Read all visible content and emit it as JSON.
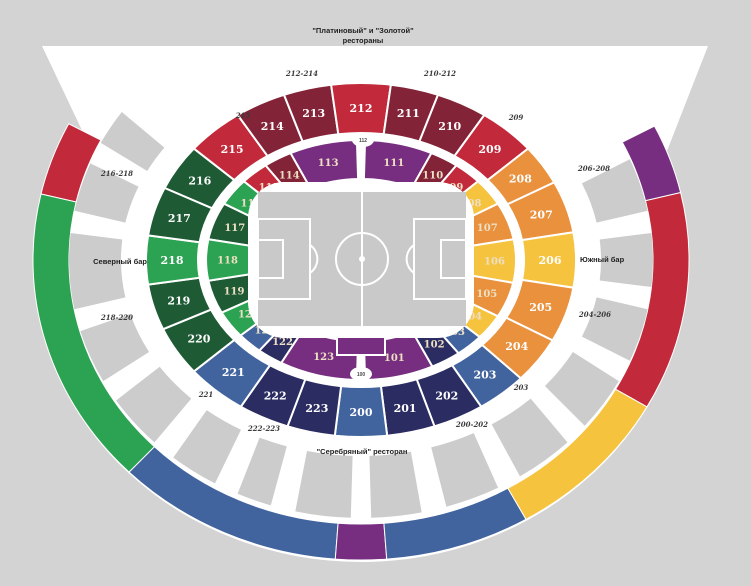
{
  "canvas": {
    "width": 751,
    "height": 586,
    "bg": "#d3d3d3"
  },
  "palette": {
    "red": "#c2293a",
    "maroon": "#832337",
    "purple": "#772d80",
    "green": "#2ca352",
    "dgreen": "#1e5b35",
    "blue": "#41649f",
    "navy": "#2b2c61",
    "orange": "#e9913d",
    "yellow": "#f5c33e",
    "suite": "#cccccc",
    "pitch": "#c9c9c9",
    "white": "#ffffff"
  },
  "labels": {
    "top_restaurant_line1": "\"Платиновый\" и \"Золотой\"",
    "top_restaurant_line2": "рестораны",
    "north_bar": "Северный бар",
    "south_bar": "Южный бар",
    "silver_restaurant": "\"Серебряный\" ресторан"
  },
  "area_labels": [
    {
      "id": "restaurants-line1",
      "t": "\"Платиновый\" и \"Золотой\"",
      "x": 363,
      "y": 33,
      "anchor": "middle"
    },
    {
      "id": "restaurants-line2",
      "t": "рестораны",
      "x": 363,
      "y": 43,
      "anchor": "middle"
    },
    {
      "id": "north-bar",
      "t": "Северный бар",
      "x": 147,
      "y": 264,
      "anchor": "end"
    },
    {
      "id": "south-bar",
      "t": "Южный бар",
      "x": 580,
      "y": 262,
      "anchor": "start"
    },
    {
      "id": "silver-restaurant",
      "t": "\"Серебряный\" ресторан",
      "x": 362,
      "y": 454,
      "anchor": "middle"
    }
  ],
  "gate_labels": [
    {
      "t": "212-214",
      "x": 302,
      "y": 76
    },
    {
      "t": "210-212",
      "x": 440,
      "y": 76
    },
    {
      "t": "215",
      "x": 243,
      "y": 118
    },
    {
      "t": "209",
      "x": 516,
      "y": 120
    },
    {
      "t": "216-218",
      "x": 117,
      "y": 176
    },
    {
      "t": "218-220",
      "x": 117,
      "y": 320
    },
    {
      "t": "206-208",
      "x": 594,
      "y": 171
    },
    {
      "t": "204-206",
      "x": 595,
      "y": 317
    },
    {
      "t": "221",
      "x": 206,
      "y": 397
    },
    {
      "t": "222-223",
      "x": 264,
      "y": 431
    },
    {
      "t": "200-202",
      "x": 472,
      "y": 427
    },
    {
      "t": "203",
      "x": 521,
      "y": 390
    }
  ],
  "outer_sections": [
    {
      "n": "216",
      "c": "dgreen",
      "a": [
        204,
        219
      ]
    },
    {
      "n": "215",
      "c": "red",
      "a": [
        219,
        235
      ]
    },
    {
      "n": "214",
      "c": "maroon",
      "a": [
        235,
        249
      ]
    },
    {
      "n": "213",
      "c": "maroon",
      "a": [
        249,
        262
      ]
    },
    {
      "n": "212",
      "c": "red",
      "a": [
        262,
        278
      ]
    },
    {
      "n": "211",
      "c": "maroon",
      "a": [
        278,
        291
      ]
    },
    {
      "n": "210",
      "c": "maroon",
      "a": [
        291,
        305
      ]
    },
    {
      "n": "209",
      "c": "red",
      "a": [
        305,
        321
      ]
    },
    {
      "n": "208",
      "c": "orange",
      "a": [
        321,
        334
      ]
    },
    {
      "n": "207",
      "c": "orange",
      "a": [
        334,
        351
      ]
    },
    {
      "n": "206",
      "c": "yellow",
      "a": [
        351,
        369
      ]
    },
    {
      "n": "205",
      "c": "orange",
      "a": [
        369,
        387
      ]
    },
    {
      "n": "204",
      "c": "orange",
      "a": [
        387,
        402
      ]
    },
    {
      "n": "203",
      "c": "blue",
      "a": [
        42,
        56
      ]
    },
    {
      "n": "202",
      "c": "navy",
      "a": [
        56,
        70
      ]
    },
    {
      "n": "201",
      "c": "navy",
      "a": [
        70,
        83
      ]
    },
    {
      "n": "200",
      "c": "blue",
      "a": [
        83,
        97
      ]
    },
    {
      "n": "223",
      "c": "navy",
      "a": [
        97,
        110
      ]
    },
    {
      "n": "222",
      "c": "navy",
      "a": [
        110,
        124
      ]
    },
    {
      "n": "221",
      "c": "blue",
      "a": [
        124,
        141
      ]
    },
    {
      "n": "220",
      "c": "dgreen",
      "a": [
        141,
        157
      ]
    },
    {
      "n": "219",
      "c": "dgreen",
      "a": [
        157,
        172
      ]
    },
    {
      "n": "218",
      "c": "green",
      "a": [
        172,
        188
      ]
    },
    {
      "n": "217",
      "c": "dgreen",
      "a": [
        188,
        204
      ]
    }
  ],
  "inner_sections": [
    {
      "n": "117",
      "c": "dgreen",
      "a": [
        190,
        208
      ]
    },
    {
      "n": "116",
      "c": "green",
      "a": [
        208,
        221
      ]
    },
    {
      "n": "115",
      "c": "red",
      "a": [
        221,
        232
      ]
    },
    {
      "n": "114",
      "c": "maroon",
      "a": [
        232,
        243
      ]
    },
    {
      "n": "113",
      "c": "purple",
      "a": [
        243,
        268.5
      ]
    },
    {
      "n": "111",
      "c": "purple",
      "a": [
        271.5,
        297
      ]
    },
    {
      "n": "110",
      "c": "maroon",
      "a": [
        297,
        308
      ]
    },
    {
      "n": "109",
      "c": "red",
      "a": [
        308,
        319
      ]
    },
    {
      "n": "108",
      "c": "yellow",
      "a": [
        319,
        332
      ]
    },
    {
      "n": "107",
      "c": "orange",
      "a": [
        332,
        350
      ]
    },
    {
      "n": "106",
      "c": "yellow",
      "a": [
        350,
        371
      ]
    },
    {
      "n": "105",
      "c": "orange",
      "a": [
        371,
        388
      ]
    },
    {
      "n": "104",
      "c": "yellow",
      "a": [
        28,
        40
      ]
    },
    {
      "n": "103",
      "c": "blue",
      "a": [
        40,
        51
      ]
    },
    {
      "n": "102",
      "c": "navy",
      "a": [
        51,
        62.6
      ]
    },
    {
      "n": "101",
      "c": "purple",
      "a": [
        62.6,
        88.5
      ]
    },
    {
      "n": "123",
      "c": "purple",
      "a": [
        91.5,
        121
      ]
    },
    {
      "n": "122",
      "c": "navy",
      "a": [
        121,
        131
      ]
    },
    {
      "n": "121",
      "c": "blue",
      "a": [
        131,
        141
      ]
    },
    {
      "n": "120",
      "c": "green",
      "a": [
        141,
        154
      ]
    },
    {
      "n": "119",
      "c": "dgreen",
      "a": [
        154,
        170
      ]
    },
    {
      "n": "118",
      "c": "green",
      "a": [
        170,
        190
      ]
    }
  ],
  "ovals": [
    {
      "n": "112",
      "x": 363,
      "y": 140
    },
    {
      "n": "100",
      "x": 361,
      "y": 374
    }
  ],
  "decor_segments": [
    {
      "c": "red",
      "a": [
        192.7,
        207
      ]
    },
    {
      "c": "green",
      "a": [
        135,
        192.7
      ]
    },
    {
      "c": "blue",
      "a": [
        94.5,
        135
      ]
    },
    {
      "c": "purple",
      "a": [
        85.5,
        94.5
      ]
    },
    {
      "c": "blue",
      "a": [
        59.8,
        85.5
      ]
    },
    {
      "c": "yellow",
      "a": [
        29.3,
        59.8
      ]
    },
    {
      "c": "red",
      "a": [
        -13,
        29.3
      ]
    },
    {
      "c": "purple",
      "a": [
        -26.5,
        -13
      ]
    }
  ],
  "suite_blocks": [
    [
      337,
      349
    ],
    [
      354,
      366
    ],
    [
      371,
      383
    ],
    [
      28,
      40
    ],
    [
      45,
      57
    ],
    [
      62,
      73
    ],
    [
      78,
      88
    ],
    [
      92,
      103
    ],
    [
      108,
      115
    ],
    [
      120,
      130
    ],
    [
      135,
      147
    ],
    [
      152,
      164
    ],
    [
      169,
      186
    ],
    [
      191,
      202
    ],
    [
      207,
      215
    ]
  ]
}
